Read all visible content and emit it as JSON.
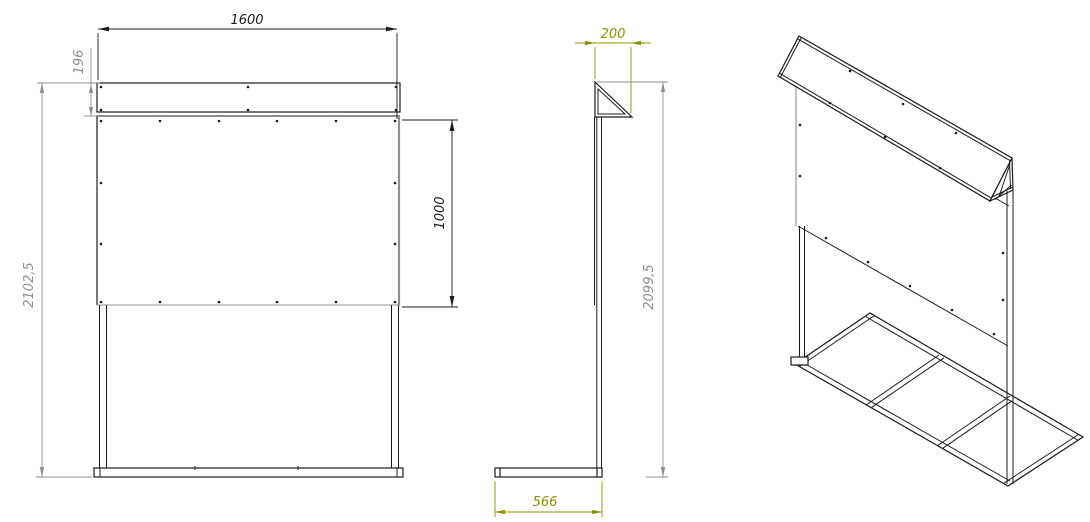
{
  "dimensions": {
    "front_width": "1600",
    "sign_band_height": "196",
    "front_overall_height": "2102,5",
    "panel_height": "1000",
    "side_top_depth": "200",
    "side_overall_height": "2099,5",
    "base_depth": "566"
  },
  "colors": {
    "object_line": "#1c1c1c",
    "dim_gray": "#8f8f8f",
    "dim_olive": "#8f8f00",
    "background": "#ffffff"
  }
}
